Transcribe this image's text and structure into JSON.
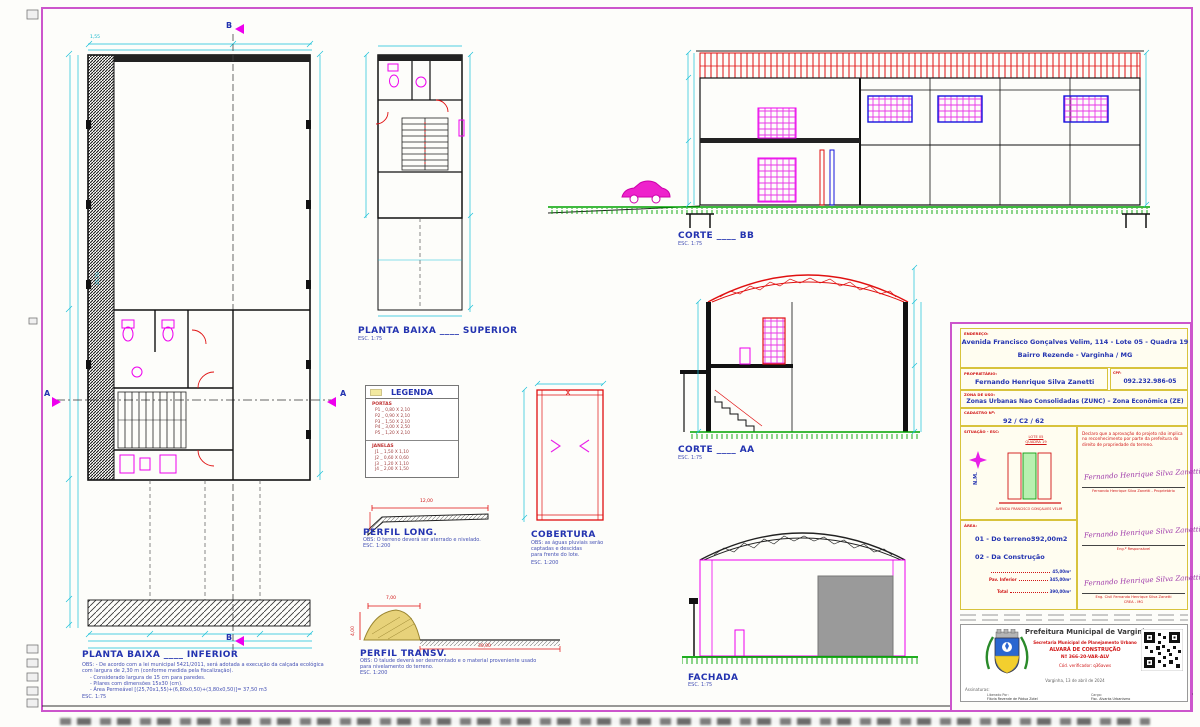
{
  "colors": {
    "frame": "#cc55cc",
    "cyan": "#10b6cc",
    "blue": "#2333b0",
    "red": "#d01414",
    "magenta": "#ee00ee",
    "green": "#00a300",
    "yellow_border": "#d8c33c"
  },
  "views": {
    "planta_inferior": {
      "title": "PLANTA  BAIXA  ____  INFERIOR",
      "obs1": "OBS: - De acordo com a lei municipal 5421/2011, será adotada a execução da calçada ecológica",
      "obs2": "com largura de 2,30 m (conforme medida pela fiscalização).",
      "obs3": "- Considerado largura de 15 cm para paredes.",
      "obs4": "- Pilares com dimensões 15x30 (cm).",
      "obs5": "- Área Permeável [(25,70x1,55)+(6,80x0,50)+(3,80x0,50)]= 37,50 m3",
      "esc": "ESC. 1:75",
      "dim_strip": "25,70",
      "dim_strip_w": "1,55"
    },
    "planta_superior": {
      "title": "PLANTA  BAIXA  ____  SUPERIOR",
      "esc": "ESC. 1:75"
    },
    "corte_bb": {
      "title": "CORTE  ____  BB",
      "esc": "ESC. 1:75"
    },
    "corte_aa": {
      "title": "CORTE  ____  AA",
      "esc": "ESC. 1:75"
    },
    "cobertura": {
      "title": "COBERTURA",
      "obs1": "OBS: as águas pluviais serão",
      "obs2": "captadas e descidas",
      "obs3": "para frente do lote.",
      "esc": "ESC. 1:200"
    },
    "perfil_long": {
      "title": "PERFIL LONG.",
      "obs1": "OBS: O terreno deverá ser aterrado e nivelado.",
      "esc": "ESC. 1:200",
      "dim_w": "12,00"
    },
    "perfil_transv": {
      "title": "PERFIL TRANSV.",
      "obs1": "OBS: O talude deverá ser desmontado e o material proveniente usado",
      "obs2": "para nivelamento do terreno.",
      "esc": "ESC. 1:200",
      "dim_h": "4,00",
      "dim_top": "7,00",
      "dim_w": "30,00"
    },
    "fachada": {
      "title": "FACHADA",
      "esc": "ESC. 1:75"
    }
  },
  "markers": {
    "a": "A",
    "b": "B"
  },
  "legend": {
    "title": "LEGENDA",
    "portas_label": "PORTAS",
    "portas": [
      "P1 _ 0,80 X 2,10",
      "P2 _ 0,90 X 2,10",
      "P3 _ 1,50 X 2,10",
      "P4 _ 3,00 X 2,50",
      "P5 _ 1,20 X 2,10"
    ],
    "janelas_label": "JANELAS",
    "janelas": [
      "J1 _ 1,50 X 1,10",
      "J2 _ 0,60 X 0,60",
      "J3 _ 1,20 X 1,10",
      "J4 _ 2,00 X 1,50"
    ]
  },
  "titleblock": {
    "endereco_label": "ENDEREÇO:",
    "endereco_1": "Avenida Francisco Gonçalves Velim, 114 - Lote 05 - Quadra 19",
    "endereco_2": "Bairro Rezende - Varginha / MG",
    "proprietario_label": "PROPRIETÁRIO:",
    "proprietario": "Fernando Henrique Silva Zanetti",
    "cpf_label": "CPF:",
    "cpf": "092.232.986-05",
    "zona_label": "ZONA DE USO:",
    "zona": "Zonas Urbanas Nao Consolidadas (ZUNC) – Zona Econômica (ZE)",
    "cadastro_label": "CADASTRO Nº:",
    "cadastro": "92 / C2 / 62",
    "situacao_label": "SITUAÇÃO - ESC:",
    "situacao_top_1": "LOTE 05",
    "situacao_top_2": "QUADRA 19",
    "situacao_bottom": "AVENIDA FRANCISCO GONÇALVES VELIM",
    "nm": "N.M.",
    "declaracao": "Declaro que a aprovação do projeto não implica no reconhecimento por parte da prefeitura do direito de propriedade do terreno.",
    "assinatura": "Fernando Henrique Silva Zanetti",
    "sig1_caption": "Fernando Henrique Silva Zanetti - Proprietário",
    "sig2_caption": "Eng.º Responsável",
    "sig3_caption_1": "Eng. Civil Fernando Henrique Silva Zanetti",
    "sig3_caption_2": "CREA - MG",
    "areas_label": "ÁREA:",
    "areas_1a": "01 - Do terreno:",
    "areas_1b": "392,00m2",
    "areas_2": "02 - Da Construção",
    "row1_label": "Pav. Superior",
    "row1_value": "45,00m²",
    "row2_label": "Pav. Inferior",
    "row2_value": "345,00m²",
    "row3_label": "Total",
    "row3_value": "390,00m²"
  },
  "alvara": {
    "orgao": "Prefeitura Municipal de Varginha",
    "secretaria": "Secretaria Municipal de Planejamento Urbano",
    "tipo": "ALVARÁ DE CONSTRUÇÃO",
    "numero": "Nº 366-20-VAR-ALV",
    "verificador": "Cód. verificador: q36avws",
    "data": "Varginha, 13 de abril de 2024",
    "assinaturas_label": "Assinaturas:",
    "liberado_label": "Liberado Por:",
    "liberado": "Flávia Rezende de Pádua Zotel",
    "cargo_label": "Cargo:",
    "cargo": "Fisc. Alvarás Urbanismo"
  }
}
